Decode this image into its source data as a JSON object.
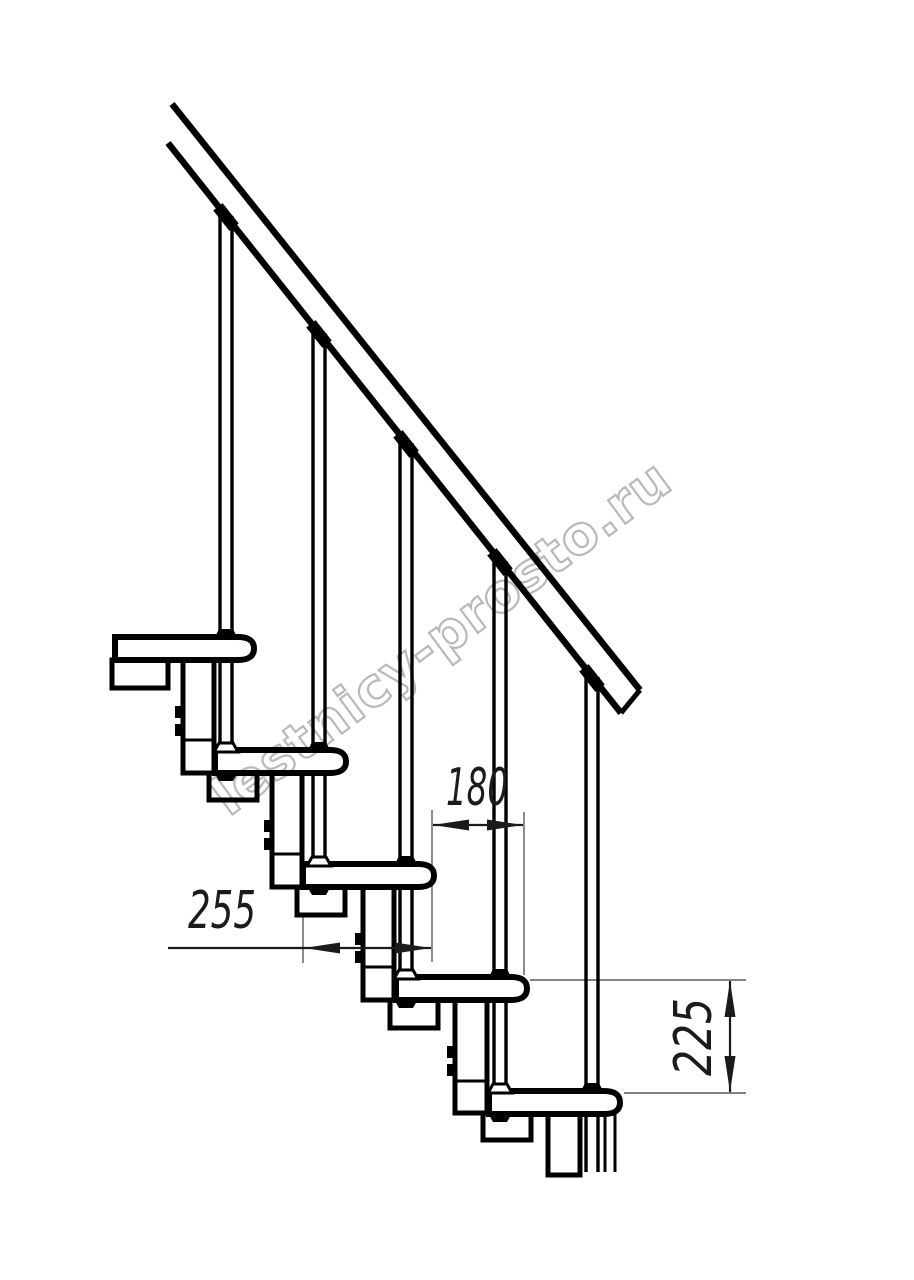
{
  "watermark": {
    "text": "lestnicy-prosto.ru",
    "color": "#adadad",
    "angle_deg": -36.5
  },
  "style": {
    "line_color": "#000000",
    "ext_color": "#5a5a5a",
    "dim_color": "#1b1b1b",
    "bg": "#ffffff"
  },
  "drawing": {
    "treads": [
      {
        "x": 115,
        "y": 637,
        "r": 252
      },
      {
        "x": 215,
        "y": 750,
        "r": 344
      },
      {
        "x": 303,
        "y": 864,
        "r": 432
      },
      {
        "x": 396,
        "y": 977,
        "r": 525
      },
      {
        "x": 489,
        "y": 1091,
        "r": 618
      }
    ],
    "tread_h": 23,
    "rail": {
      "upper": [
        172,
        104,
        640,
        690
      ],
      "lower": [
        168,
        143,
        621,
        713
      ],
      "cap": [
        640,
        690,
        621,
        713
      ],
      "slope_deg": 51.5
    },
    "balusters": [
      {
        "cx": 226,
        "top": 216,
        "own": 0,
        "land": 1
      },
      {
        "cx": 319,
        "top": 333,
        "own": 1,
        "land": 2
      },
      {
        "cx": 406,
        "top": 443,
        "own": 2,
        "land": 3
      },
      {
        "cx": 500,
        "top": 561,
        "own": 3,
        "land": 4
      },
      {
        "cx": 592,
        "top": 677,
        "own": 4,
        "land": null,
        "below": [
          1114,
          1172
        ]
      }
    ],
    "extra_post": {
      "x1": 605,
      "x2": 615,
      "y1": 1114,
      "y2": 1172
    },
    "spine": [
      {
        "stub": [
          112,
          660,
          168,
          688
        ]
      },
      {
        "col": [
          183,
          660,
          214,
          773
        ],
        "seam": 740,
        "tab_x": 175,
        "tabs": [
          706,
          724
        ],
        "stub": [
          209,
          773,
          257,
          800
        ]
      },
      {
        "col": [
          272,
          773,
          302,
          887
        ],
        "seam": 854,
        "tab_x": 264,
        "tabs": [
          820,
          838
        ],
        "stub": [
          297,
          887,
          345,
          915
        ]
      },
      {
        "col": [
          363,
          887,
          394,
          1000
        ],
        "seam": 967,
        "tab_x": 355,
        "tabs": [
          933,
          951
        ],
        "stub": [
          390,
          1000,
          438,
          1028
        ]
      },
      {
        "col": [
          455,
          1000,
          487,
          1113
        ],
        "seam": 1081,
        "tab_x": 447,
        "tabs": [
          1046,
          1064
        ],
        "stub": [
          483,
          1113,
          531,
          1140
        ]
      },
      {
        "col": [
          548,
          1114,
          580,
          1175
        ]
      }
    ],
    "dimensions": [
      {
        "id": "step-run",
        "value": "180",
        "type": "h",
        "y": 825,
        "x1": 433,
        "x2": 523,
        "arrows": [
          433,
          523
        ],
        "ext": [
          [
            432,
            810,
            432,
            962
          ],
          [
            524,
            812,
            524,
            975
          ]
        ],
        "tx": 477,
        "ty": 805,
        "textLength": 62
      },
      {
        "id": "tread-depth",
        "value": "255",
        "type": "h",
        "y": 948,
        "x1": 168,
        "x2": 431,
        "arrows": [
          304,
          431
        ],
        "ext": [
          [
            303,
            911,
            303,
            963
          ]
        ],
        "tx": 222,
        "ty": 928,
        "textLength": 68
      },
      {
        "id": "riser-height",
        "value": "225",
        "type": "v",
        "x": 730,
        "y1": 981,
        "y2": 1092,
        "ext": [
          [
            530,
            980,
            746,
            980
          ],
          [
            624,
            1093,
            746,
            1093
          ]
        ],
        "tx": 697,
        "ty": 1037,
        "textLength": 78,
        "rotate": -90
      }
    ]
  }
}
